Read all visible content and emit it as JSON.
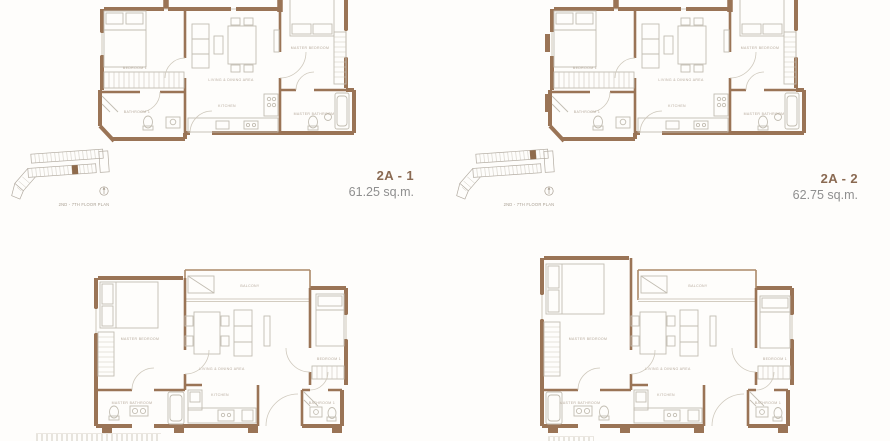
{
  "colors": {
    "wall": "#9a7456",
    "furniture_line": "#c2bdb2",
    "room_label": "#b6aa9c",
    "unit_name": "#8a6a52",
    "unit_area": "#8f8f8f",
    "keyplan_line": "#b2aba1",
    "keyplan_highlight": "#8f6b4c",
    "background": "#fefdfb"
  },
  "units": [
    {
      "name": "2A - 1",
      "area": "61.25 sq.m.",
      "keyplan_caption": "2ND - 7TH FLOOR PLAN",
      "rooms": {
        "bedroom1": "BEDROOM 1",
        "living": "LIVING & DINING AREA",
        "master_bedroom": "MASTER BEDROOM",
        "kitchen": "KITCHEN",
        "bathroom1": "BATHROOM 1",
        "master_bathroom": "MASTER BATHROOM"
      }
    },
    {
      "name": "2A - 2",
      "area": "62.75 sq.m.",
      "keyplan_caption": "2ND - 7TH FLOOR PLAN",
      "rooms": {
        "bedroom1": "BEDROOM 1",
        "living": "LIVING & DINING AREA",
        "master_bedroom": "MASTER BEDROOM",
        "kitchen": "KITCHEN",
        "bathroom1": "BATHROOM 1",
        "master_bathroom": "MASTER BATHROOM"
      }
    },
    {
      "rooms": {
        "master_bedroom": "MASTER BEDROOM",
        "balcony": "BALCONY",
        "living": "LIVING & DINING AREA",
        "bedroom1": "BEDROOM 1",
        "master_bathroom": "MASTER BATHROOM",
        "kitchen": "KITCHEN",
        "bathroom1": "BATHROOM 1"
      }
    },
    {
      "rooms": {
        "master_bedroom": "MASTER BEDROOM",
        "balcony": "BALCONY",
        "living": "LIVING & DINING AREA",
        "bedroom1": "BEDROOM 1",
        "master_bathroom": "MASTER BATHROOM",
        "kitchen": "KITCHEN",
        "bathroom1": "BATHROOM 1"
      }
    }
  ]
}
